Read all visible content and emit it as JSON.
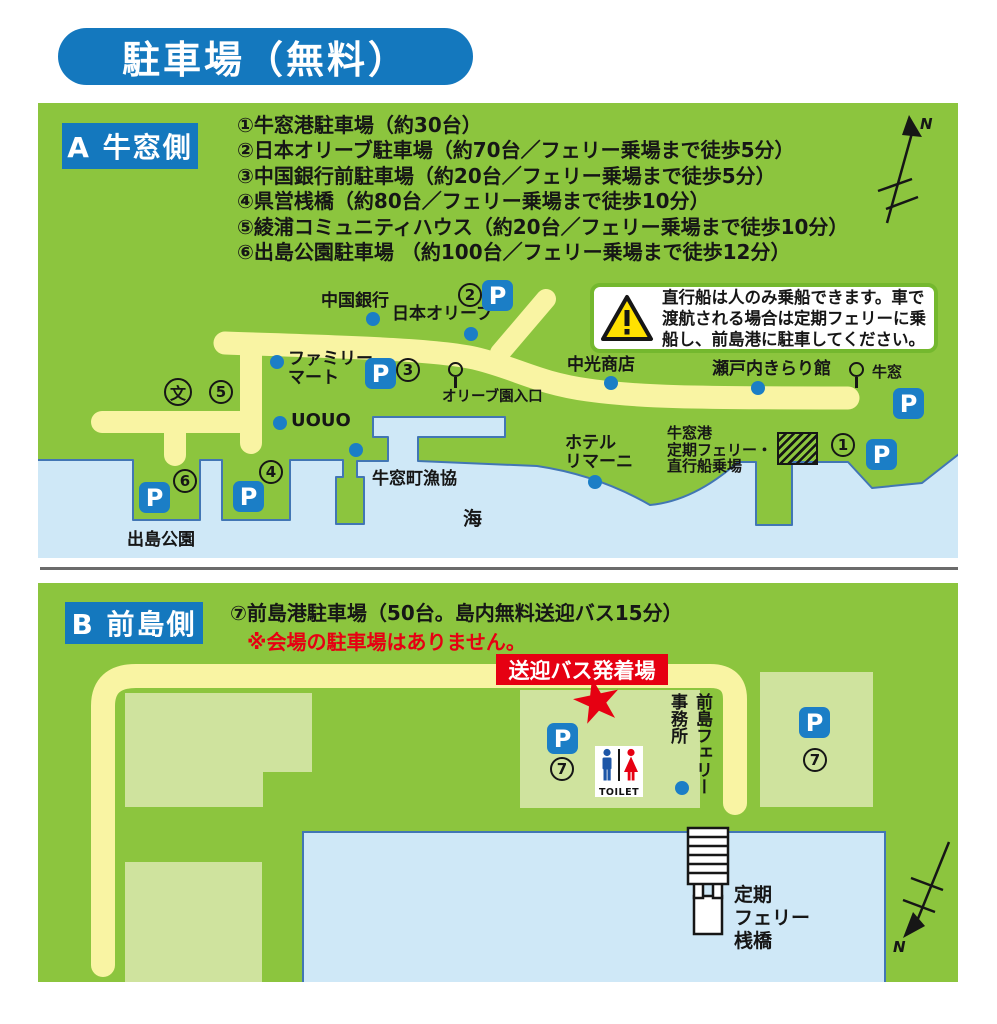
{
  "title": "駐車場（無料）",
  "map_a": {
    "section_label": "A 牛窓側",
    "list": [
      "①牛窓港駐車場（約30台）",
      "②日本オリーブ駐車場（約70台／フェリー乗場まで徒歩5分）",
      "③中国銀行前駐車場（約20台／フェリー乗場まで徒歩5分）",
      "④県営桟橋（約80台／フェリー乗場まで徒歩10分）",
      "⑤綾浦コミュニティハウス（約20台／フェリー乗場まで徒歩10分）",
      "⑥出島公園駐車場 （約100台／フェリー乗場まで徒歩12分）"
    ],
    "warning": [
      "直行船は人のみ乗船できます。車で",
      "渡航される場合は定期フェリーに乗",
      "船し、前島港に駐車してください。"
    ],
    "labels": {
      "chugoku_bank": "中国銀行",
      "nihon_olive": "日本オリーブ",
      "family_mart": "ファミリー\nマート",
      "olive_en_iriguchi": "オリーブ園入口",
      "chuko_shoten": "中光商店",
      "setouchi_kirarikan": "瀬戸内きらり館",
      "ushimado_busstop": "牛窓",
      "uouo": "UOUO",
      "ushimado_gyokyo": "牛窓町漁協",
      "hotel_limani": "ホテル\nリマーニ",
      "ferry_noriba": "牛窓港\n定期フェリー・\n直行船乗場",
      "dejima_koen": "出島公園",
      "sea": "海",
      "school": "文"
    },
    "markers": {
      "n1": "1",
      "n2": "2",
      "n3": "3",
      "n4": "4",
      "n5": "5",
      "n6": "6"
    },
    "p": "P",
    "compass_n": "N"
  },
  "map_b": {
    "section_label": "B 前島側",
    "list_line": "⑦前島港駐車場（50台。島内無料送迎バス15分）",
    "note": "※会場の駐車場はありません。",
    "bus_banner": "送迎バス発着場",
    "star": "★",
    "labels": {
      "jimusho": "前島フェリー\n事務所",
      "pier": "定期\nフェリー\n桟橋",
      "toilet": "TOILET"
    },
    "marker7": "7",
    "p": "P",
    "compass_n": "N"
  }
}
